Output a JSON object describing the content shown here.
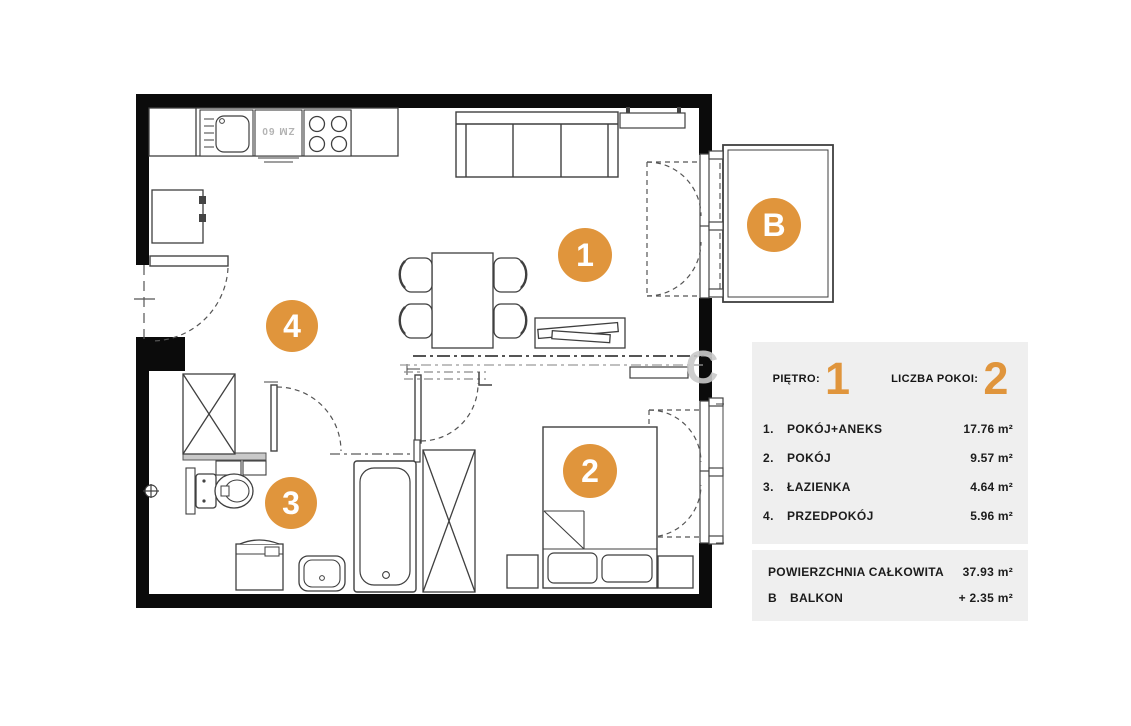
{
  "colors": {
    "accent": "#E0953C",
    "wall": "#0b0b0b",
    "line": "#3f3f3f",
    "panel_bg": "#EFEFEF"
  },
  "plan": {
    "markers": {
      "living": "1",
      "bedroom": "2",
      "bathroom": "3",
      "hallway": "4",
      "balcony": "B"
    },
    "dishwasher_label": "ZM 60",
    "watermark": "C"
  },
  "panel": {
    "floor": {
      "label": "PIĘTRO:",
      "value": "1"
    },
    "rooms_count": {
      "label": "LICZBA POKOI:",
      "value": "2"
    },
    "rooms": [
      {
        "num": "1.",
        "name": "POKÓJ+ANEKS",
        "area": "17.76 m²"
      },
      {
        "num": "2.",
        "name": "POKÓJ",
        "area": "9.57 m²"
      },
      {
        "num": "3.",
        "name": "ŁAZIENKA",
        "area": "4.64 m²"
      },
      {
        "num": "4.",
        "name": "PRZEDPOKÓJ",
        "area": "5.96 m²"
      }
    ],
    "total": {
      "label": "POWIERZCHNIA CAŁKOWITA",
      "value": "37.93 m²"
    },
    "balcony": {
      "prefix": "B",
      "label": "BALKON",
      "value": "+ 2.35 m²"
    }
  }
}
